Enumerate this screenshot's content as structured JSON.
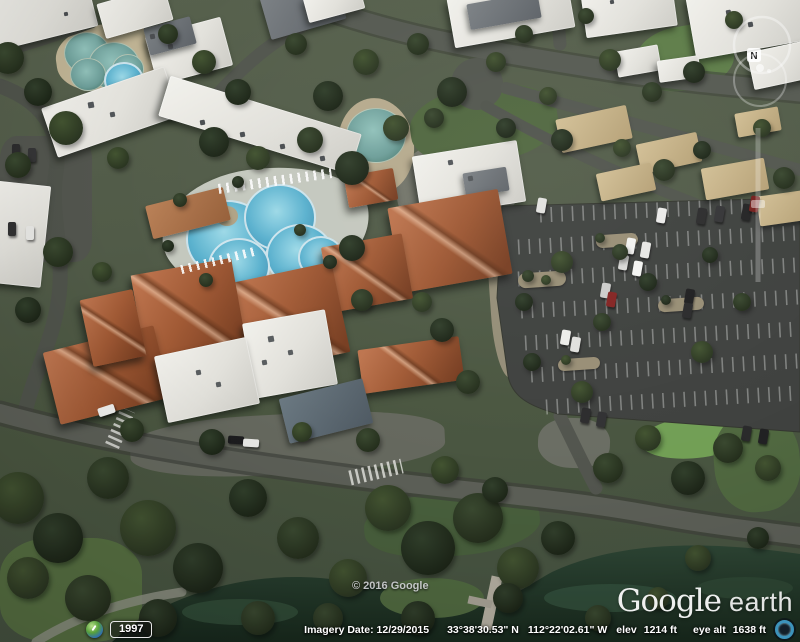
{
  "app": {
    "name": "Google Earth"
  },
  "navigation": {
    "north_label": "N",
    "look_ring_icon": "compass-look-ring-icon",
    "move_ring_icon": "move-joystick-ring-icon",
    "zoom_slider_icon": "zoom-slider"
  },
  "time_control": {
    "icon": "historical-imagery-clock-icon",
    "year": "1997"
  },
  "status_bar": {
    "imagery_date": "Imagery Date: 12/29/2015",
    "latitude": "33°38'30.53\" N",
    "longitude": "112°22'02.61\" W",
    "elev_label": "elev",
    "elevation": "1214 ft",
    "eye_alt_label": "eye alt",
    "eye_altitude": "1638 ft",
    "streaming_icon": "streaming-indicator-icon"
  },
  "overlay": {
    "copyright": "© 2016 Google",
    "watermark_brand": "Google",
    "watermark_product": "earth"
  },
  "colors": {
    "pool_water": "#55b4d4",
    "lagoon_water": "#6aa09a",
    "pond_water": "#1f3628",
    "terracotta_roof": "#a85a31",
    "white_roof": "#e8e7e2",
    "tan_roof": "#c8b385",
    "asphalt": "#53574e",
    "parking_asphalt": "#3f423f",
    "grass": "#4e653c",
    "golf_green": "#70a251",
    "tree_canopy": "#2c3a23"
  }
}
